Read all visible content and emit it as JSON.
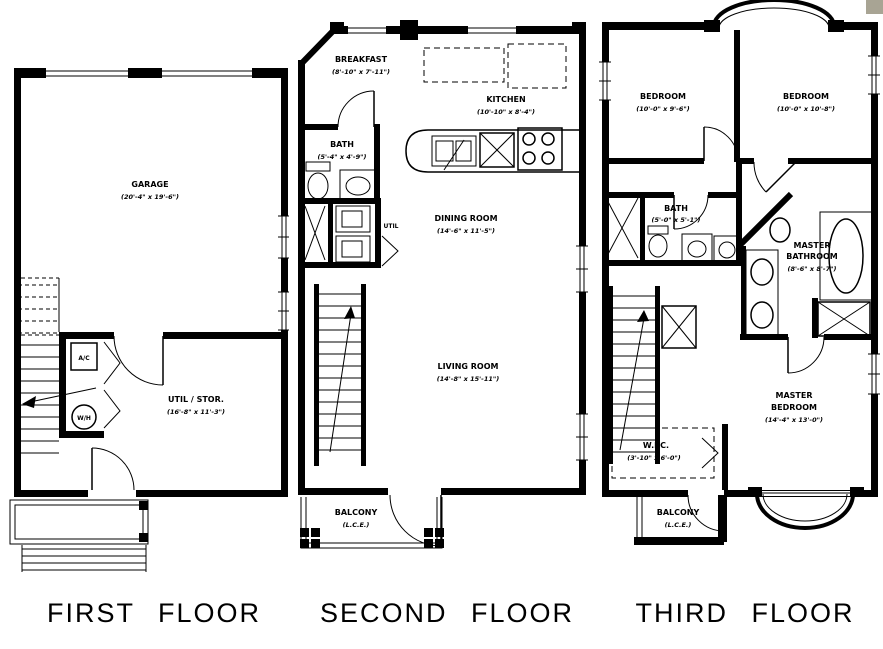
{
  "page": {
    "corner_mark_color": "#a8a494"
  },
  "floors": {
    "first": {
      "title": "FIRST FLOOR",
      "rooms": {
        "garage": {
          "name": "GARAGE",
          "dims": "(20'-4\" x 19'-6\")"
        },
        "util_stor": {
          "name": "UTIL / STOR.",
          "dims": "(16'-8\" x 11'-3\")"
        }
      },
      "fixtures": {
        "ac": "A/C",
        "wh": "W/H"
      }
    },
    "second": {
      "title": "SECOND FLOOR",
      "rooms": {
        "breakfast": {
          "name": "BREAKFAST",
          "dims": "(8'-10\" x 7'-11\")"
        },
        "kitchen": {
          "name": "KITCHEN",
          "dims": "(10'-10\" x 8'-4\")"
        },
        "bath": {
          "name": "BATH",
          "dims": "(5'-4\" x 4'-9\")"
        },
        "util": {
          "name": "UTIL"
        },
        "dining": {
          "name": "DINING ROOM",
          "dims": "(14'-6\" x 11'-5\")"
        },
        "living": {
          "name": "LIVING ROOM",
          "dims": "(14'-8\" x 15'-11\")"
        },
        "balcony": {
          "name": "BALCONY",
          "dims": "(L.C.E.)"
        }
      }
    },
    "third": {
      "title": "THIRD FLOOR",
      "rooms": {
        "bedroom_left": {
          "name": "BEDROOM",
          "dims": "(10'-0\" x 9'-6\")"
        },
        "bedroom_right": {
          "name": "BEDROOM",
          "dims": "(10'-0\" x 10'-8\")"
        },
        "bath": {
          "name": "BATH",
          "dims": "(5'-0\" x 5'-1\")"
        },
        "master_bath": {
          "name1": "MASTER",
          "name2": "BATHROOM",
          "dims": "(8'-6\" x 8'-7\")"
        },
        "master_bedroom": {
          "name1": "MASTER",
          "name2": "BEDROOM",
          "dims": "(14'-4\" x 13'-0\")"
        },
        "wic": {
          "name": "W.I.C.",
          "dims": "(3'-10\" x 6'-0\")"
        },
        "balcony": {
          "name": "BALCONY",
          "dims": "(L.C.E.)"
        }
      }
    }
  }
}
